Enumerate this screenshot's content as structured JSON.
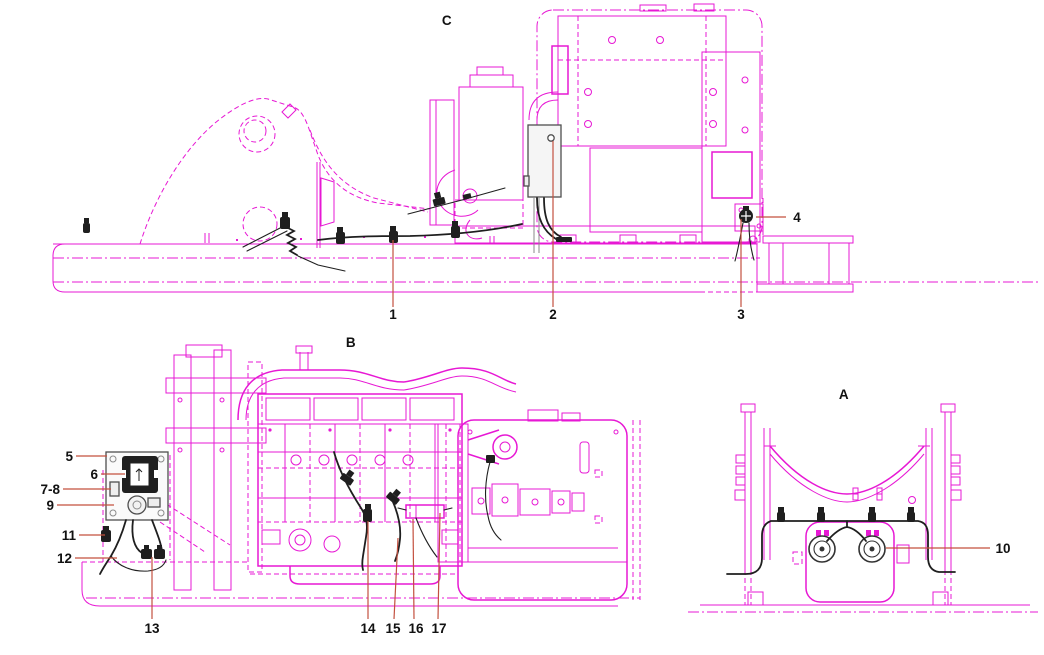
{
  "diagram": {
    "title": "machine harness installation diagram",
    "colors": {
      "background": "#ffffff",
      "artwork": "#e718d4",
      "harness": "#1f1f1f",
      "leader": "#c3503f",
      "label": "#111111",
      "box_gray": "#4f4f4f"
    },
    "views": {
      "c": {
        "label": "C"
      },
      "b": {
        "label": "B"
      },
      "a": {
        "label": "A"
      }
    },
    "callouts": {
      "c1": "1",
      "c2": "2",
      "c3": "3",
      "c4": "4",
      "c5": "5",
      "c6": "6",
      "c7_8": "7-8",
      "c9": "9",
      "c10": "10",
      "c11": "11",
      "c12": "12",
      "c13": "13",
      "c14": "14",
      "c15": "15",
      "c16": "16",
      "c17": "17"
    }
  }
}
